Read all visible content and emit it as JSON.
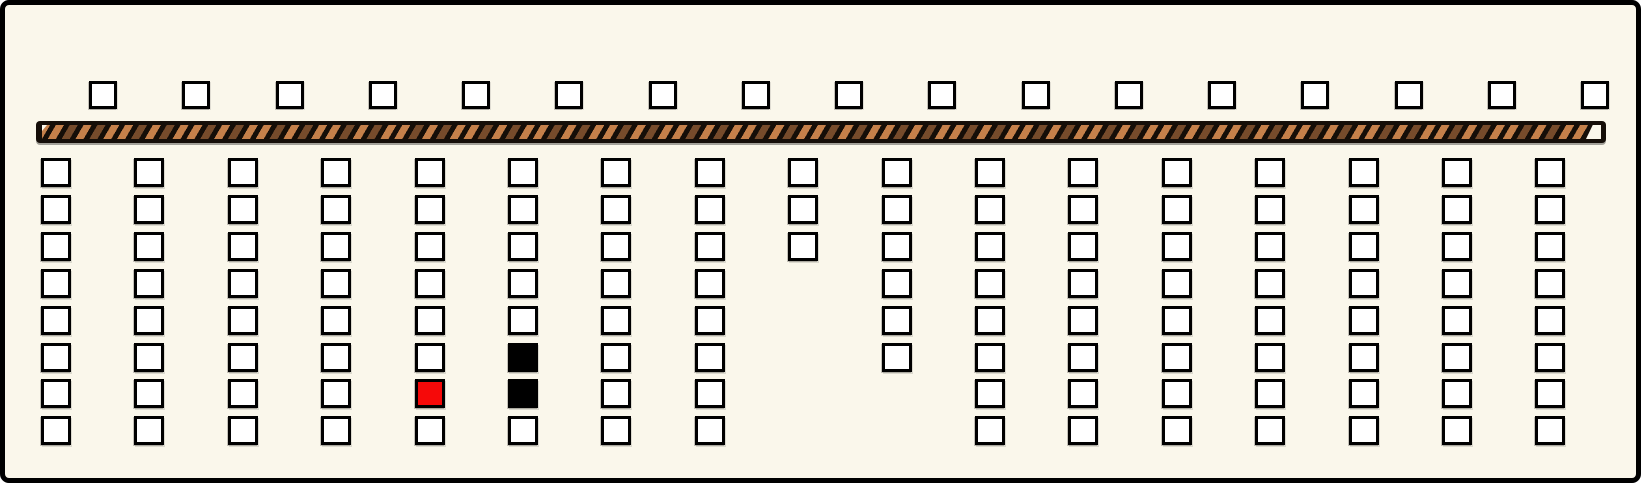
{
  "figure": {
    "name": "striped-bar-square-grid-panel",
    "description": "Cream panel with a row of 17 small empty squares above a brown diagonally-hatched horizontal bar, and 17 columns of outlined squares below it; one square is red and two squares are black."
  },
  "colors": {
    "canvas_background": "#FAF7EB",
    "frame_border": "#000000",
    "cell_border": "#000000",
    "cell_fill_white": "#FFFFFF",
    "cell_fill_red": "#F60909",
    "cell_fill_black": "#000000",
    "bar_background": "#150E08",
    "bar_stripe_light": "#C5804A",
    "bar_stripe_dark": "#764B2B"
  },
  "layout_counts": {
    "top_slot_count": 17,
    "grid_column_count": 17,
    "grid_max_rows": 8
  },
  "top_row": {
    "slots": [
      "white",
      "white",
      "white",
      "white",
      "white",
      "white",
      "white",
      "white",
      "white",
      "white",
      "white",
      "white",
      "white",
      "white",
      "white",
      "white",
      "white"
    ]
  },
  "grid": {
    "columns": [
      [
        "white",
        "white",
        "white",
        "white",
        "white",
        "white",
        "white",
        "white"
      ],
      [
        "white",
        "white",
        "white",
        "white",
        "white",
        "white",
        "white",
        "white"
      ],
      [
        "white",
        "white",
        "white",
        "white",
        "white",
        "white",
        "white",
        "white"
      ],
      [
        "white",
        "white",
        "white",
        "white",
        "white",
        "white",
        "white",
        "white"
      ],
      [
        "white",
        "white",
        "white",
        "white",
        "white",
        "white",
        "red",
        "white"
      ],
      [
        "white",
        "white",
        "white",
        "white",
        "white",
        "black",
        "black",
        "white"
      ],
      [
        "white",
        "white",
        "white",
        "white",
        "white",
        "white",
        "white",
        "white"
      ],
      [
        "white",
        "white",
        "white",
        "white",
        "white",
        "white",
        "white",
        "white"
      ],
      [
        "white",
        "white",
        "white"
      ],
      [
        "white",
        "white",
        "white",
        "white",
        "white",
        "white"
      ],
      [
        "white",
        "white",
        "white",
        "white",
        "white",
        "white",
        "white",
        "white"
      ],
      [
        "white",
        "white",
        "white",
        "white",
        "white",
        "white",
        "white",
        "white"
      ],
      [
        "white",
        "white",
        "white",
        "white",
        "white",
        "white",
        "white",
        "white"
      ],
      [
        "white",
        "white",
        "white",
        "white",
        "white",
        "white",
        "white",
        "white"
      ],
      [
        "white",
        "white",
        "white",
        "white",
        "white",
        "white",
        "white",
        "white"
      ],
      [
        "white",
        "white",
        "white",
        "white",
        "white",
        "white",
        "white",
        "white"
      ],
      [
        "white",
        "white",
        "white",
        "white",
        "white",
        "white",
        "white",
        "white"
      ]
    ]
  }
}
